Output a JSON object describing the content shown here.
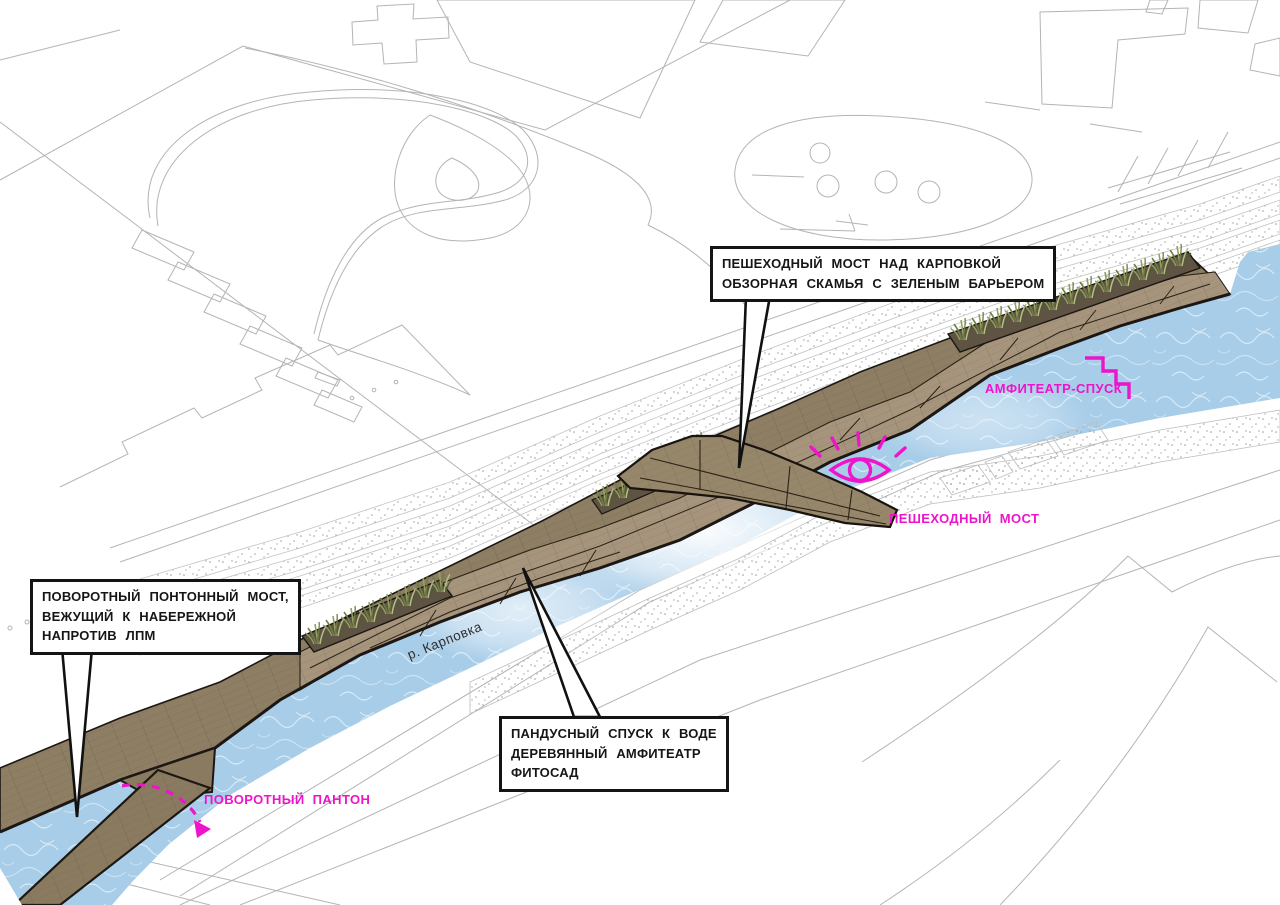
{
  "diagram": {
    "river_label": "р. Карповка",
    "callouts": [
      {
        "id": "pedestrian-bridge-callout",
        "lines": [
          "ПЕШЕХОДНЫЙ МОСТ НАД КАРПОВКОЙ",
          "ОБЗОРНАЯ СКАМЬЯ С ЗЕЛЕНЫМ БАРЬЕРОМ"
        ]
      },
      {
        "id": "pontoon-bridge-callout",
        "lines": [
          "ПОВОРОТНЫЙ ПОНТОННЫЙ МОСТ,",
          "ВЕЖУЩИЙ К НАБЕРЕЖНОЙ",
          "НАПРОТИВ ЛПМ"
        ]
      },
      {
        "id": "ramp-callout",
        "lines": [
          "ПАНДУСНЫЙ СПУСК К ВОДЕ",
          "ДЕРЕВЯННЫЙ АМФИТЕАТР",
          "ФИТОСАД"
        ]
      }
    ],
    "magenta_labels": [
      {
        "id": "amphitheatre-descent",
        "text": "АМФИТЕАТР-СПУСК",
        "icon": "stairs-icon"
      },
      {
        "id": "pedestrian-bridge",
        "text": "ПЕШЕХОДНЫЙ МОСТ",
        "icon": "eye-icon"
      },
      {
        "id": "rotating-pontoon",
        "text": "ПОВОРОТНЫЙ ПАНТОН",
        "icon": "dashed-arrow-icon"
      }
    ],
    "colors": {
      "magenta": "#ee14cb",
      "water": "#a8cde9",
      "water_swirl": "#d6eaf7",
      "wood": "#8d7e64",
      "wood_dark": "#6e5e49",
      "wood_light": "#a6957c",
      "outline": "#1c1712",
      "linework": "#b4b4b4"
    }
  }
}
